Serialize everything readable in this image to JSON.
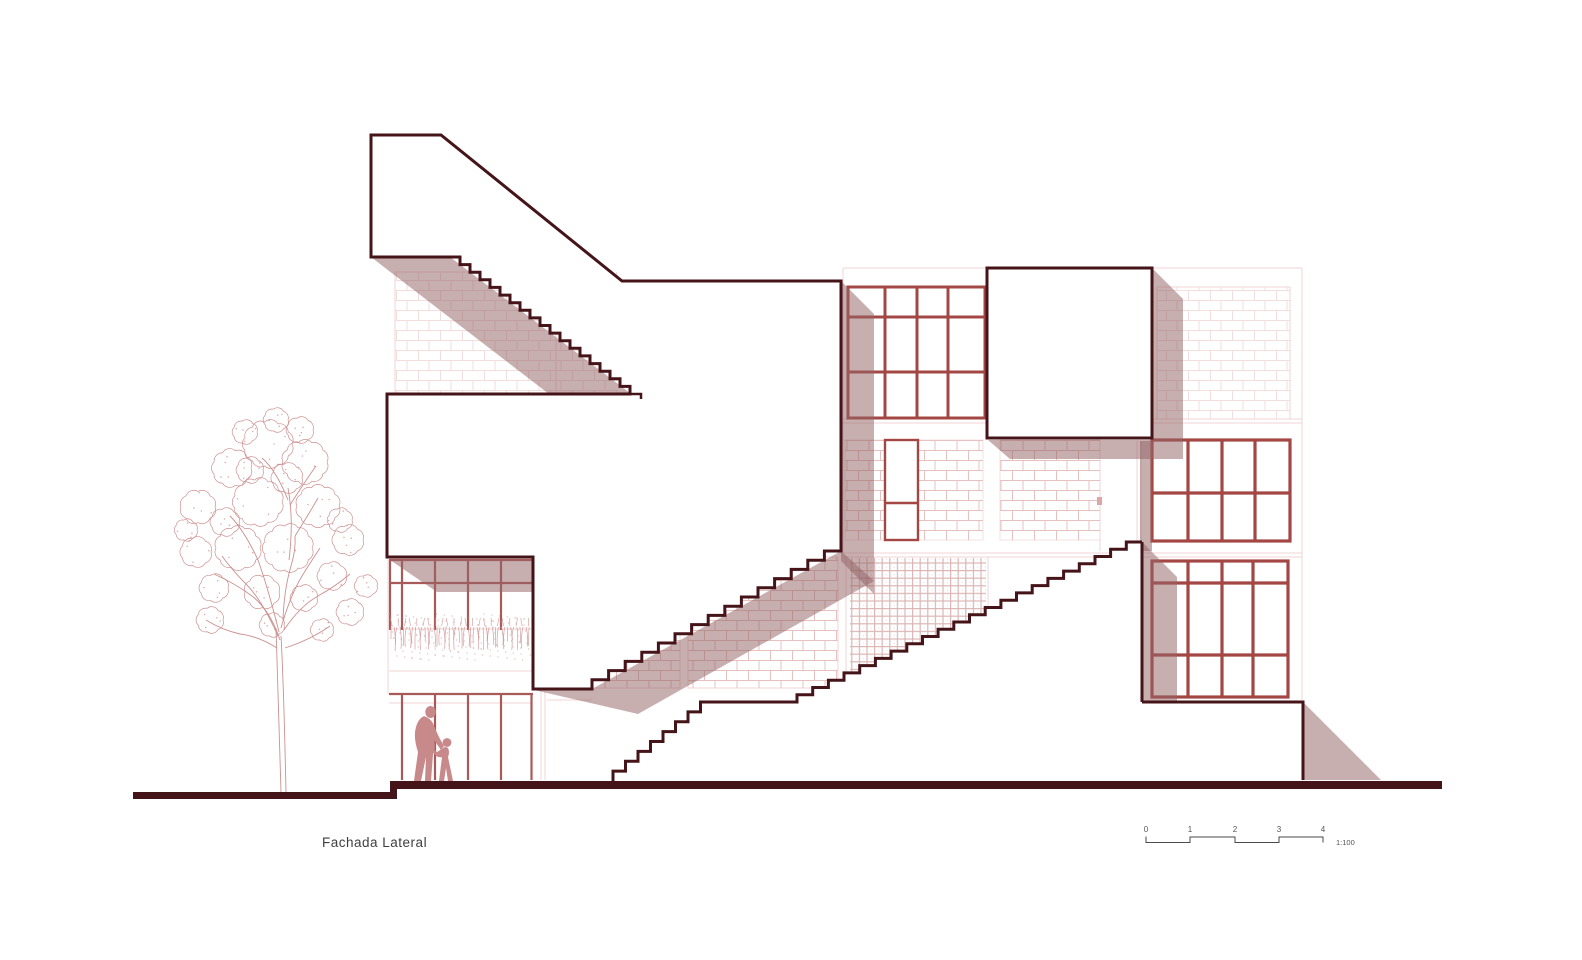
{
  "drawing": {
    "title": "Fachada Lateral",
    "scale_bar": {
      "marks": [
        "0",
        "1",
        "2",
        "3",
        "4"
      ],
      "ratio": "1:100"
    }
  },
  "colors": {
    "background": "#ffffff",
    "outline_dark": "#451419",
    "frame_red": "#a34744",
    "frame_red_light": "#a85a58",
    "shadow": "rgba(148,99,101,0.52)",
    "brick_light": "#f3dede",
    "brick_mid": "#e7c0c0",
    "lattice_line": "#d9b2b2",
    "faint": "#f0d4d6",
    "vegetation": "#cc9090",
    "figures": "#c8898b",
    "handle": "#dba7a7",
    "text": "#3f3f3f",
    "scale_text": "#555555"
  }
}
